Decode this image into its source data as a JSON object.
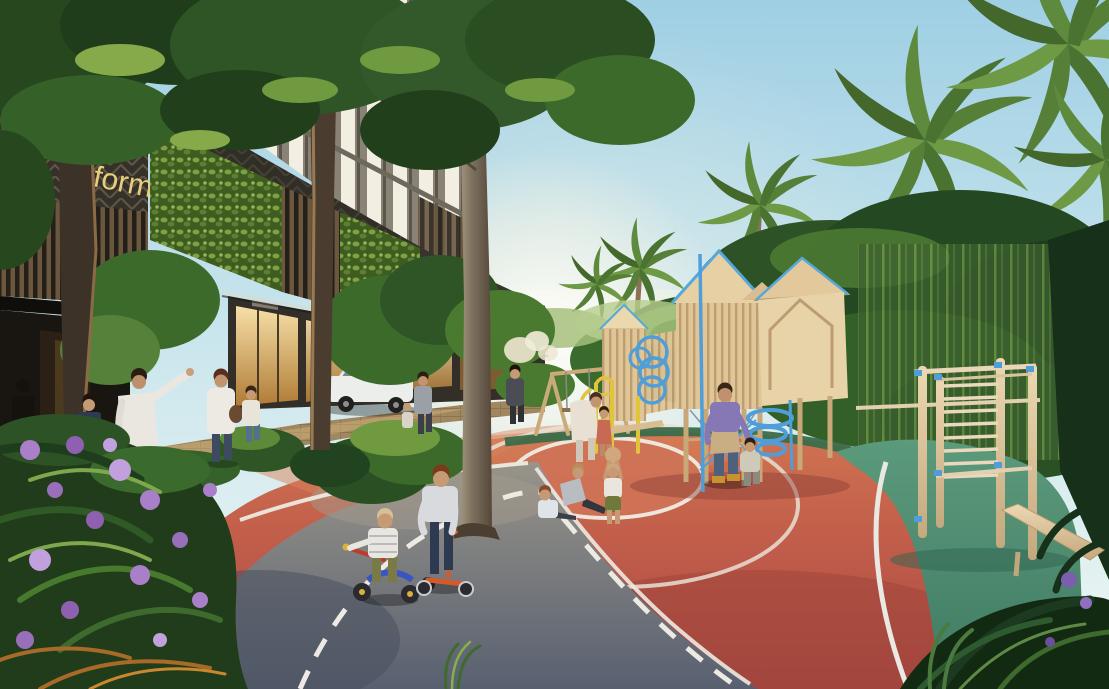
{
  "meta": {
    "title": "Courtyard playground architectural rendering",
    "description": "Photorealistic rendering of a landscaped residential courtyard: red rubber play loop, grey cycle path, wooden playhouses, calisthenics station, palm trees and a green-walled mixed-use tower in warm late-afternoon light."
  },
  "signage": {
    "fragment_top": "ES",
    "fragment_mid": "le P",
    "fragment_bottom": "form",
    "color": "#e7cf7d",
    "panel": "dark chevron-patterned fascia with brushed gold lettering and leaf emblem"
  },
  "palette": {
    "sky_top": "#9fcfe4",
    "sky_horizon": "#eaf4f0",
    "canopy_dark": "#223f1c",
    "canopy_mid": "#33592a",
    "foliage_light": "#6f9a3f",
    "palm_green": "#567f38",
    "facade_dark": "#2c2a24",
    "chevron_line": "#5d5644",
    "window_sky": "#f2efe2",
    "living_wall": "#557a2f",
    "slat_brown": "#6a573e",
    "glass_warm": "#e8b35f",
    "banner_red": "#c23a30",
    "track_red": "#c05c4a",
    "track_red_sunlit": "#d8835c",
    "path_grey": "#6e737c",
    "marking_white": "#eceae2",
    "rubber_green": "#4f8c72",
    "track_edge_green": "#3b6b4a",
    "wood_light": "#e0c697",
    "wood_mid": "#c9a878",
    "equip_blue": "#4f9ed9",
    "equip_yellow": "#e2c33c",
    "flower_purple": "#a97fc9",
    "trunk_dark": "#4a3c2e",
    "pavement_tan": "#a08760",
    "car_white": "#eceeec"
  },
  "scene": {
    "areas": [
      {
        "name": "building-tower",
        "label": "glass residential tower above retail podium"
      },
      {
        "name": "signage-fascia",
        "label": "dark fascia with partial gold sign"
      },
      {
        "name": "living-wall",
        "label": "green planted wall panels"
      },
      {
        "name": "storefront",
        "label": "warm-lit retail shopfront with red vertical banner"
      },
      {
        "name": "lobby-entrance",
        "label": "dark covered entrance"
      },
      {
        "name": "walkway",
        "label": "paved pedestrian walkway"
      },
      {
        "name": "cycle-path",
        "label": "grey path with dashed white centerline"
      },
      {
        "name": "play-track",
        "label": "terracotta-red rubber play loop with white lane arcs"
      },
      {
        "name": "fitness-lawn",
        "label": "green rubber fitness surface"
      },
      {
        "name": "playground",
        "label": "timber playhouse towers with blue slides and yellow ladders"
      },
      {
        "name": "swing-set",
        "label": "timber A-frame swings"
      },
      {
        "name": "fitness-station",
        "label": "timber calisthenics rig with blue clamps and incline bench"
      },
      {
        "name": "flower-bed",
        "label": "purple-flowering shrubs in foreground"
      },
      {
        "name": "palm-grove",
        "label": "palms and dense tropical planting"
      }
    ],
    "people": [
      {
        "name": "man-pointing",
        "description": "man in white shirt pointing toward the playground"
      },
      {
        "name": "boy-by-entrance",
        "description": "child in navy beside him"
      },
      {
        "name": "woman-with-bag",
        "description": "woman in white top with brown shoulder bag"
      },
      {
        "name": "girl-walking",
        "description": "small girl walking beside her"
      },
      {
        "name": "woman-with-toddler",
        "description": "woman in grey with toddler near the car"
      },
      {
        "name": "pedestrian",
        "description": "person walking on far path"
      },
      {
        "name": "mother-at-climber",
        "description": "woman leaning to a child at the yellow ladder"
      },
      {
        "name": "child-at-climber",
        "description": "child in coral dress"
      },
      {
        "name": "seated-child-1",
        "description": "child seated on the red track"
      },
      {
        "name": "seated-child-2",
        "description": "second seated child leaning back"
      },
      {
        "name": "toddler-with-ball",
        "description": "toddler lifting a ball overhead"
      },
      {
        "name": "toddler-on-tricycle",
        "description": "blond toddler on blue tricycle"
      },
      {
        "name": "boy-on-scooter",
        "description": "boy standing over an orange scooter"
      },
      {
        "name": "father-holding-hands",
        "description": "father in violet shirt walking a toddler"
      },
      {
        "name": "toddler-with-father",
        "description": "toddler holding father's hand"
      },
      {
        "name": "person-in-lobby",
        "description": "silhouetted figure inside the entrance"
      }
    ],
    "vehicles": [
      {
        "name": "white-suv",
        "description": "white SUV parked by the storefront"
      }
    ]
  }
}
